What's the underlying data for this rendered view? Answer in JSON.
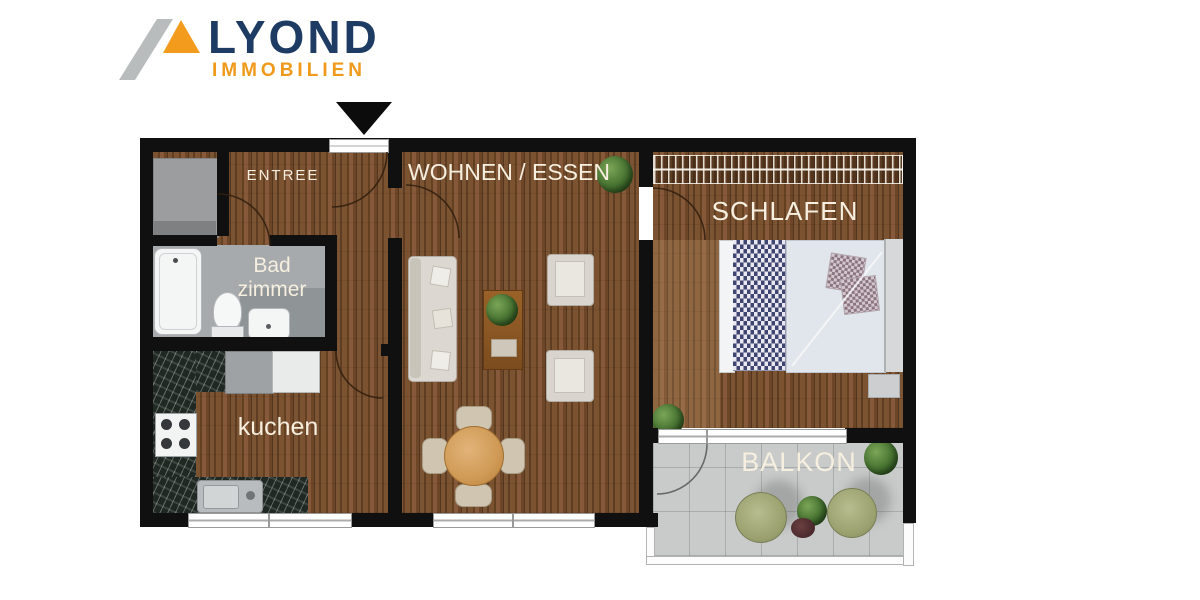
{
  "logo": {
    "brand": "LYOND",
    "tagline": "IMMOBILIEN",
    "brand_color": "#1e3c63",
    "accent_color": "#f09a1c",
    "mark_gray": "#b9bcbd"
  },
  "plan": {
    "rooms": {
      "entree": {
        "label": "ENTREE"
      },
      "living": {
        "label": "WOHNEN / ESSEN"
      },
      "bedroom": {
        "label": "SCHLAFEN"
      },
      "bathroom": {
        "label_line1": "Bad",
        "label_line2": "zimmer"
      },
      "kitchen": {
        "label": "kuchen"
      },
      "balcony": {
        "label": "BALKON"
      }
    },
    "colors": {
      "wall": "#101010",
      "wood_floor": "#6f4727",
      "bathroom_floor": "#a6aaad",
      "balcony_tile": "#c8cbca",
      "kitchen_counter": "#202823",
      "label_text": "#f6efdf"
    }
  }
}
